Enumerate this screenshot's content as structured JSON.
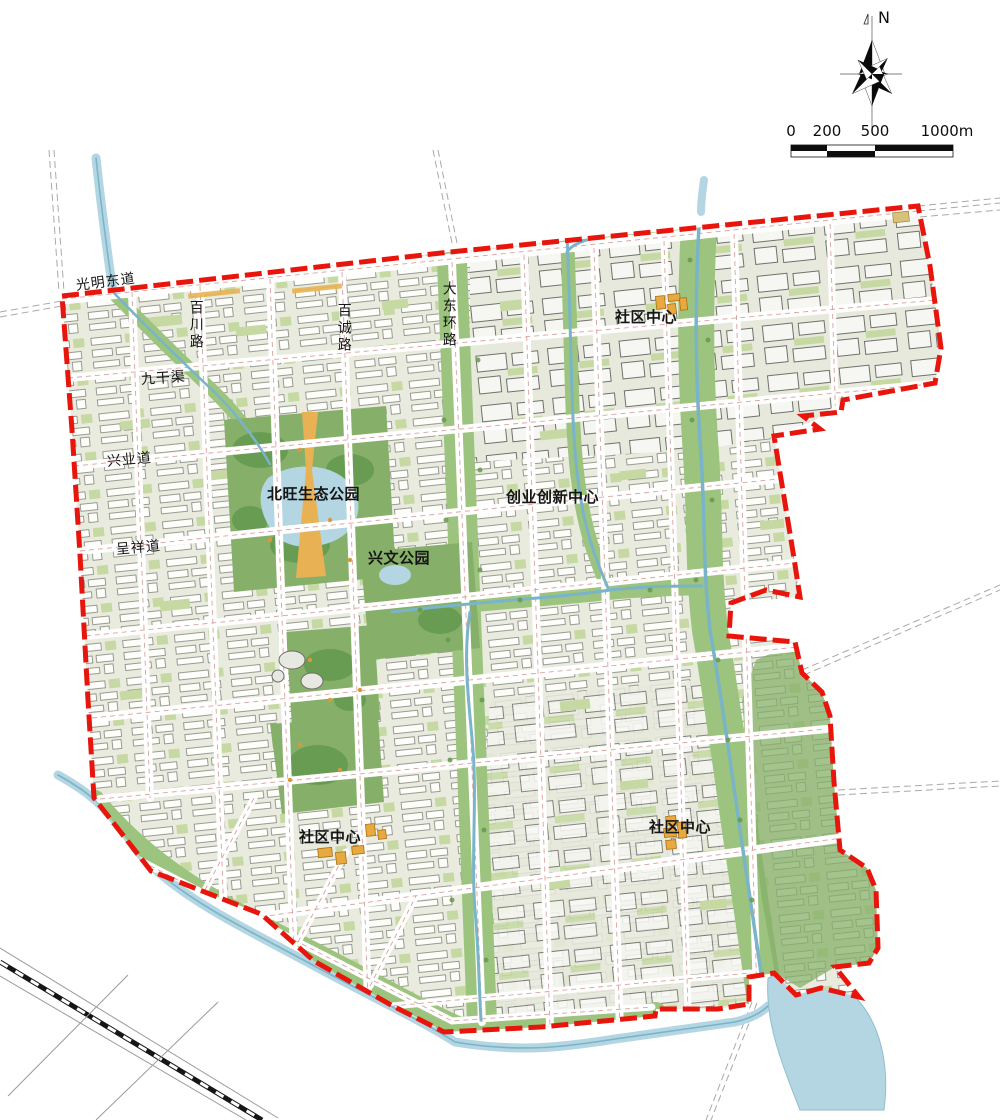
{
  "compass": {
    "north_label": "N"
  },
  "scale_bar": {
    "ticks": [
      "0",
      "200",
      "500",
      "1000m"
    ]
  },
  "roads": {
    "guangming_east": "光明东道",
    "baichuan": "百川路",
    "baicheng": "百诚路",
    "jiugan_canal": "九干渠",
    "xingye": "兴业道",
    "chengxiang": "呈祥道",
    "dadong_ring": "大东环路"
  },
  "places": {
    "beiwang_eco_park": "北旺生态公园",
    "xingwen_park": "兴文公园",
    "community_center_north": "社区中心",
    "innovation_center": "创业创新中心",
    "community_center_southwest": "社区中心",
    "community_center_southeast": "社区中心"
  },
  "colors": {
    "boundary": "#e8150d",
    "water": "#b3d6e2",
    "stream": "#79b4c8",
    "park": "#86b069",
    "corridor": "#9cc47e",
    "blockgreen": "#c6d9a3",
    "orange": "#e8aa3f",
    "gold": "#e8b254",
    "roadline": "#d4908c"
  }
}
